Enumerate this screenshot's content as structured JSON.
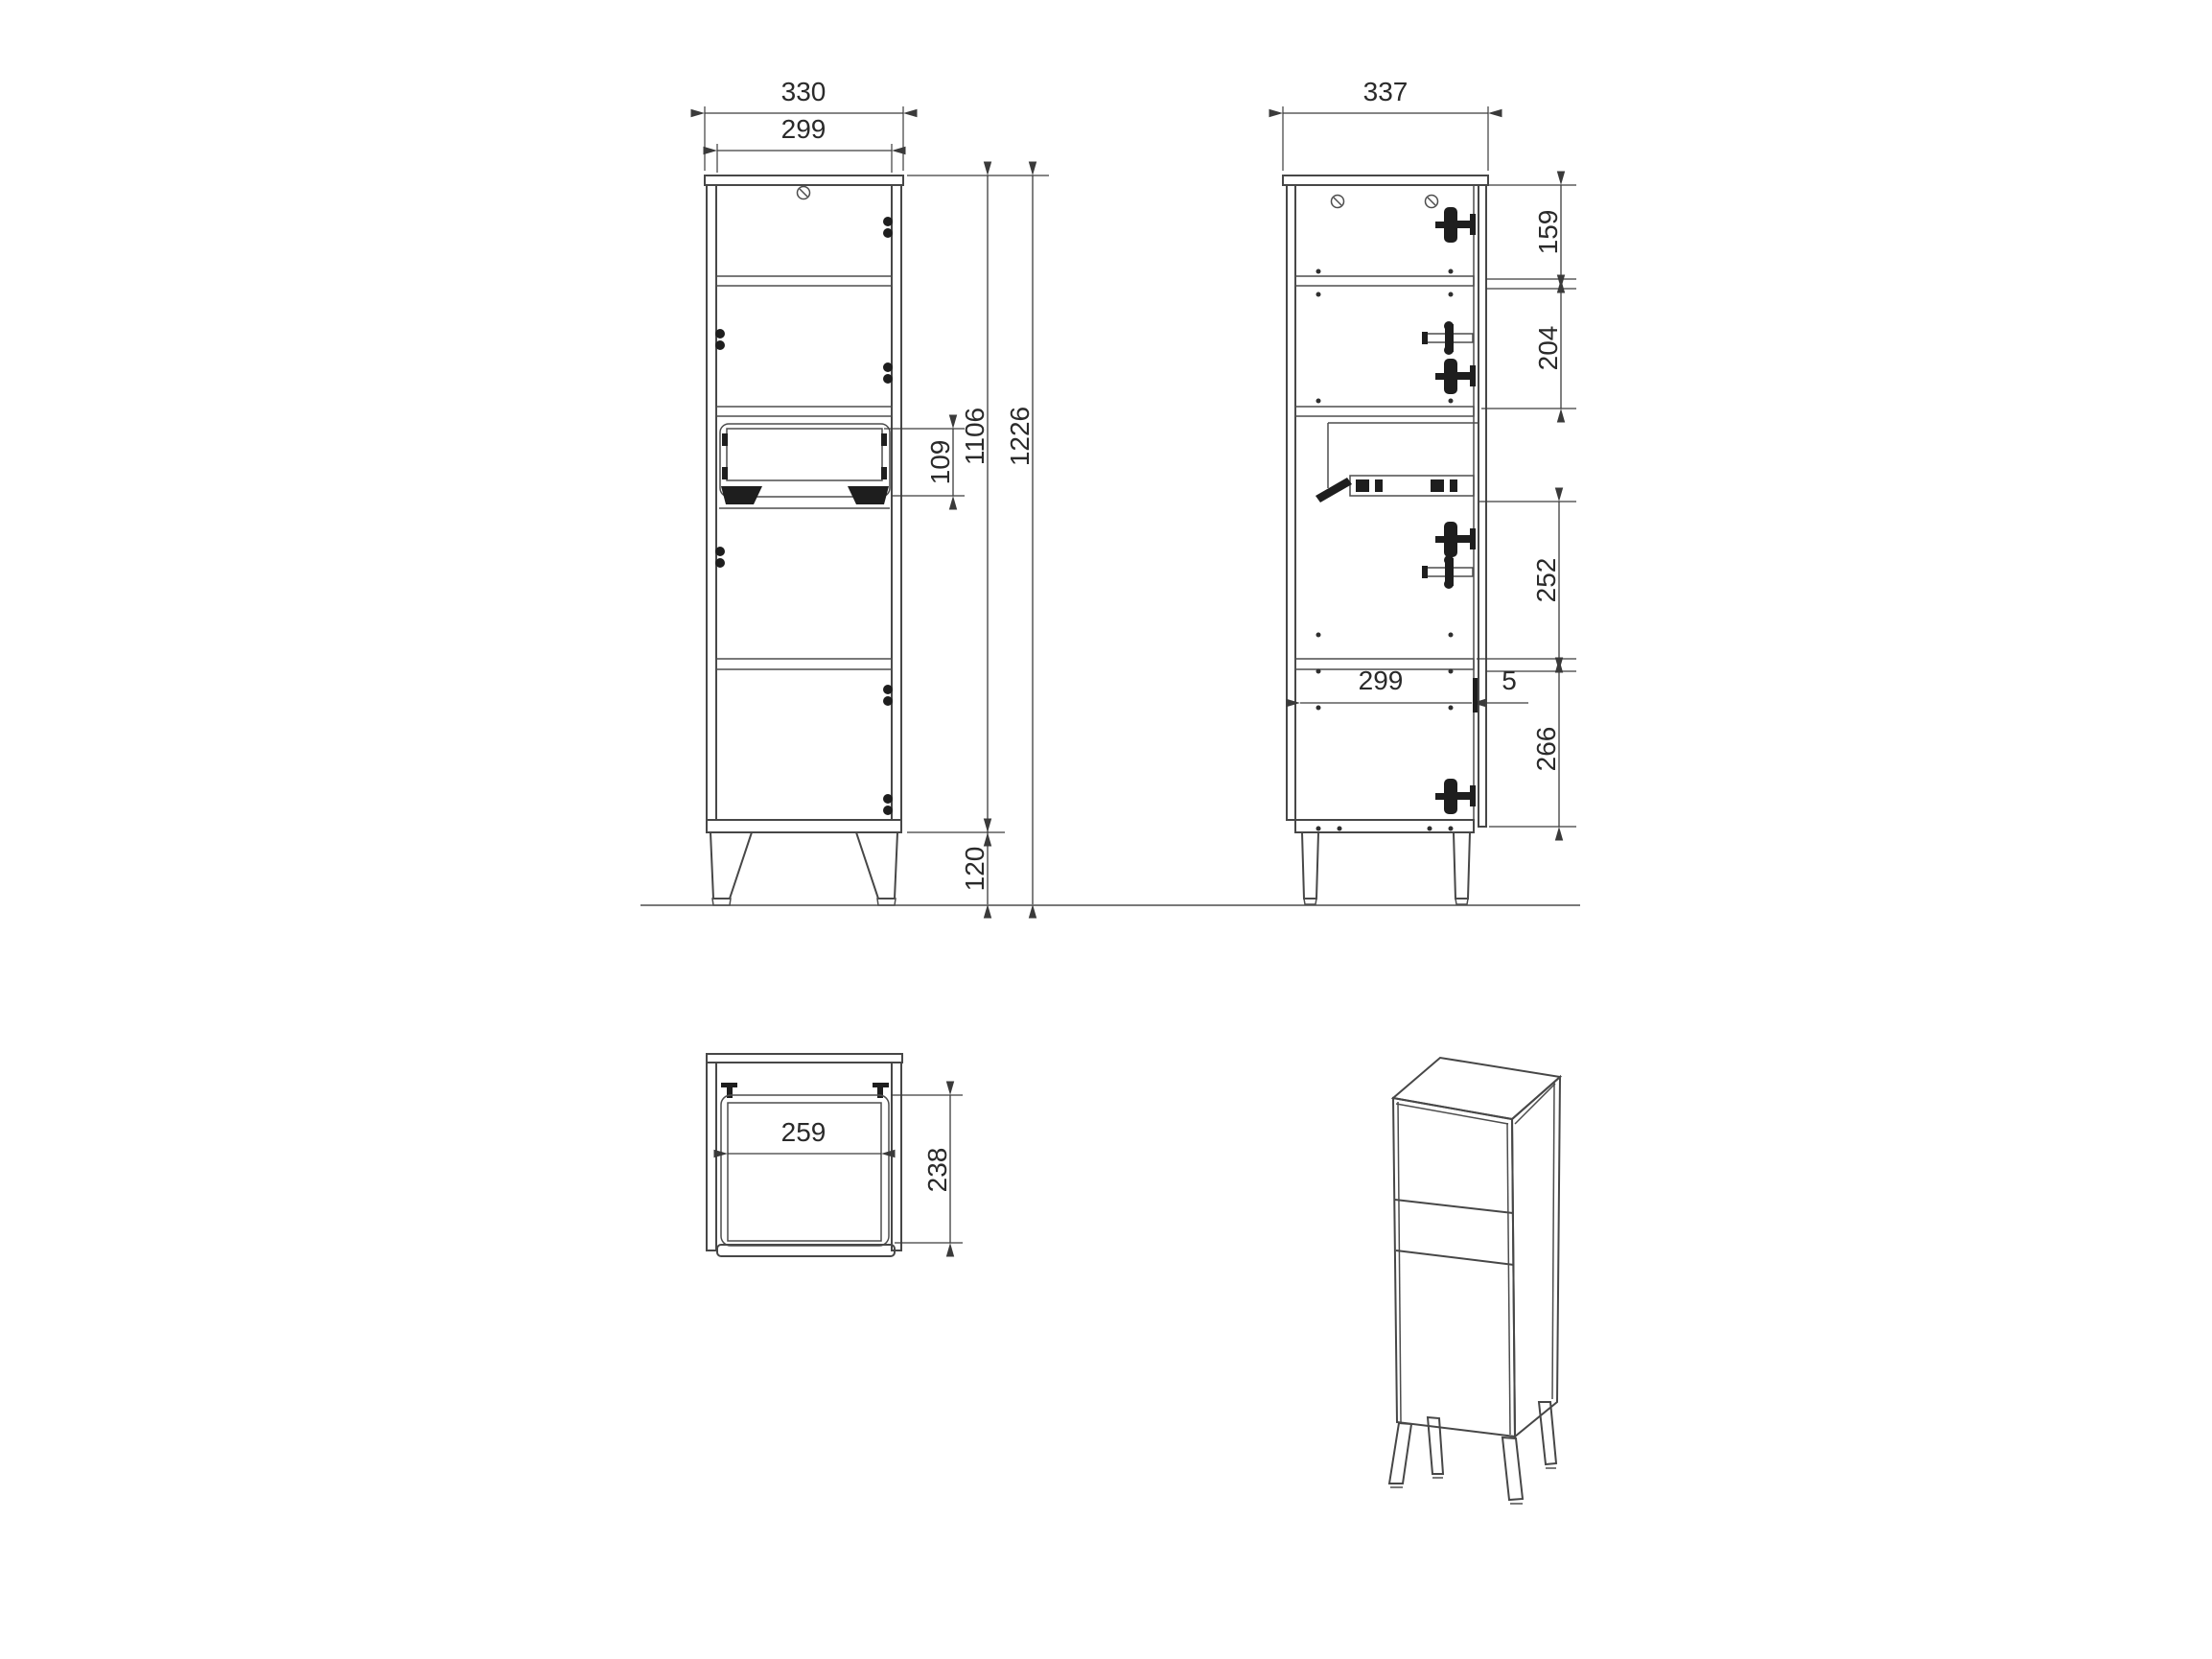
{
  "drawing_title": "cabinet-technical-drawing",
  "views": {
    "front": {
      "outer_width": "330",
      "inner_width": "299",
      "drawer_front_height": "109",
      "carcass_height": "1106",
      "total_height": "1226",
      "leg_height": "120"
    },
    "side": {
      "depth": "337",
      "top_section": "159",
      "upper_section": "204",
      "middle_section": "252",
      "interior_depth": "299",
      "front_gap": "5",
      "bottom_section": "266"
    },
    "top": {
      "drawer_inner_width": "259",
      "drawer_depth": "238"
    }
  },
  "colors": {
    "line": "#474747",
    "dimension": "#3c3c3c",
    "text": "#2a2a2a",
    "hardware": "#1e1e1e",
    "background": "#ffffff"
  }
}
